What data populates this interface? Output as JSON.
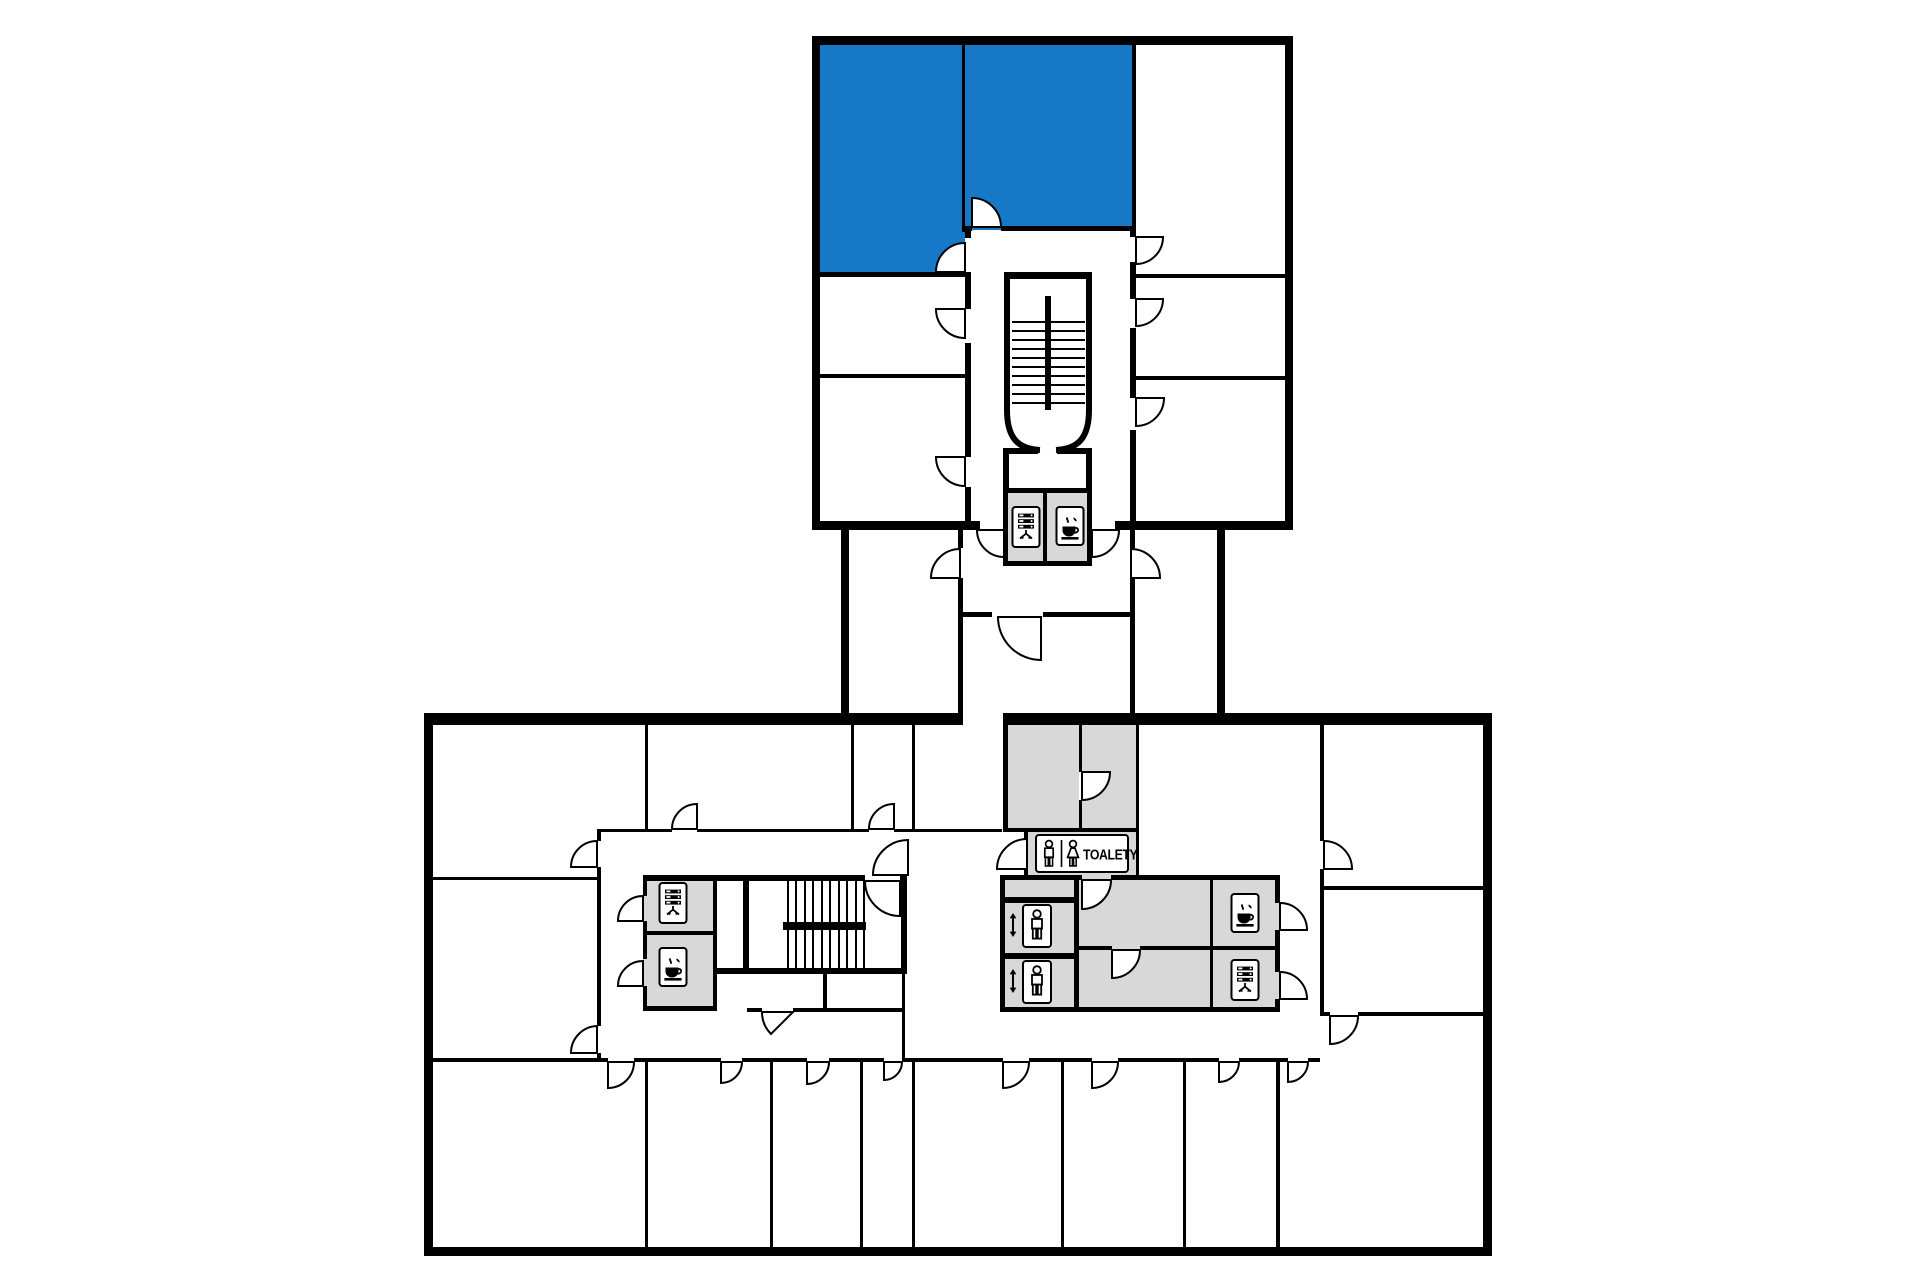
{
  "plan": {
    "type": "building-floor-plan",
    "description": "Two-wing office floor plan connected by a neck corridor; two highlighted units in upper wing",
    "colors": {
      "highlight": "#1878c8",
      "roomgray": "#d8d8d8",
      "wall": "#000000",
      "bg": "#ffffff"
    },
    "toilet_sign": {
      "label": "TOALETY"
    },
    "highlighted_rooms": [
      {
        "id": "upper-wing-room-top-left",
        "state": "highlighted"
      },
      {
        "id": "upper-wing-room-top-center",
        "state": "highlighted"
      }
    ],
    "icons": {
      "upper_core": [
        "vending-machine-icon",
        "coffee-icon"
      ],
      "lower_left_core": [
        "vending-machine-icon",
        "coffee-icon"
      ],
      "lower_center_core": [
        "wc-man-icon",
        "wc-woman-icon",
        "elevator-icon",
        "elevator-icon",
        "coffee-icon",
        "vending-machine-icon"
      ]
    },
    "features": [
      "stairwell-upper",
      "stairwell-lower",
      "elevator-shafts",
      "toilets",
      "door-swings"
    ]
  }
}
